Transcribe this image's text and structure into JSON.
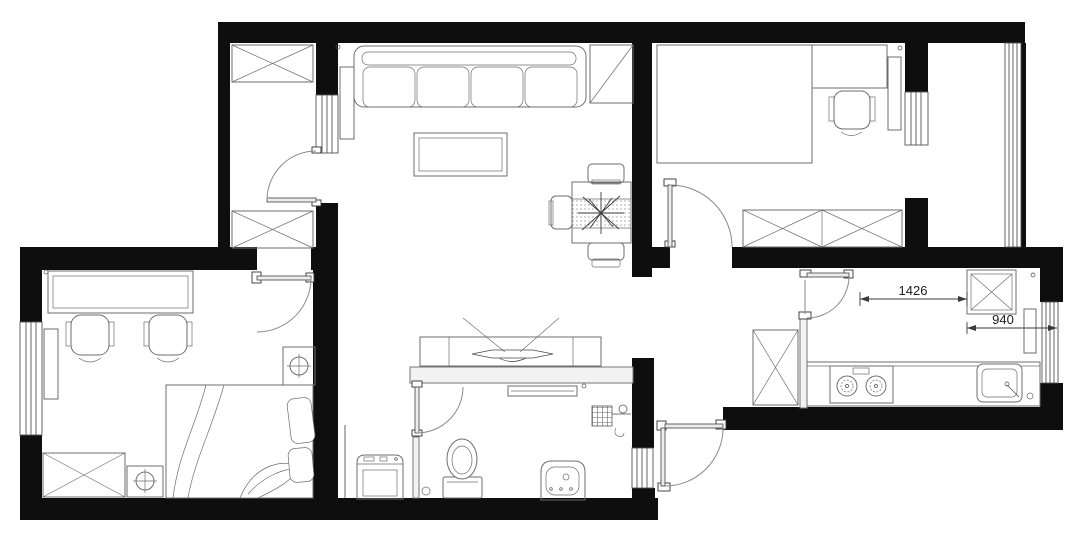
{
  "plan": {
    "type": "residential-floor-plan",
    "dimension_labels": {
      "dim1": "1426",
      "dim2": "940"
    },
    "colors": {
      "wall": "#0e0e0e",
      "furniture_line": "#6e6e6e",
      "detail_line": "#4a4a4a",
      "hollow_wall_fill": "#f2f2f2",
      "window_line": "#555555",
      "dimension_text": "#1c1c1c",
      "background": "#ffffff"
    }
  }
}
